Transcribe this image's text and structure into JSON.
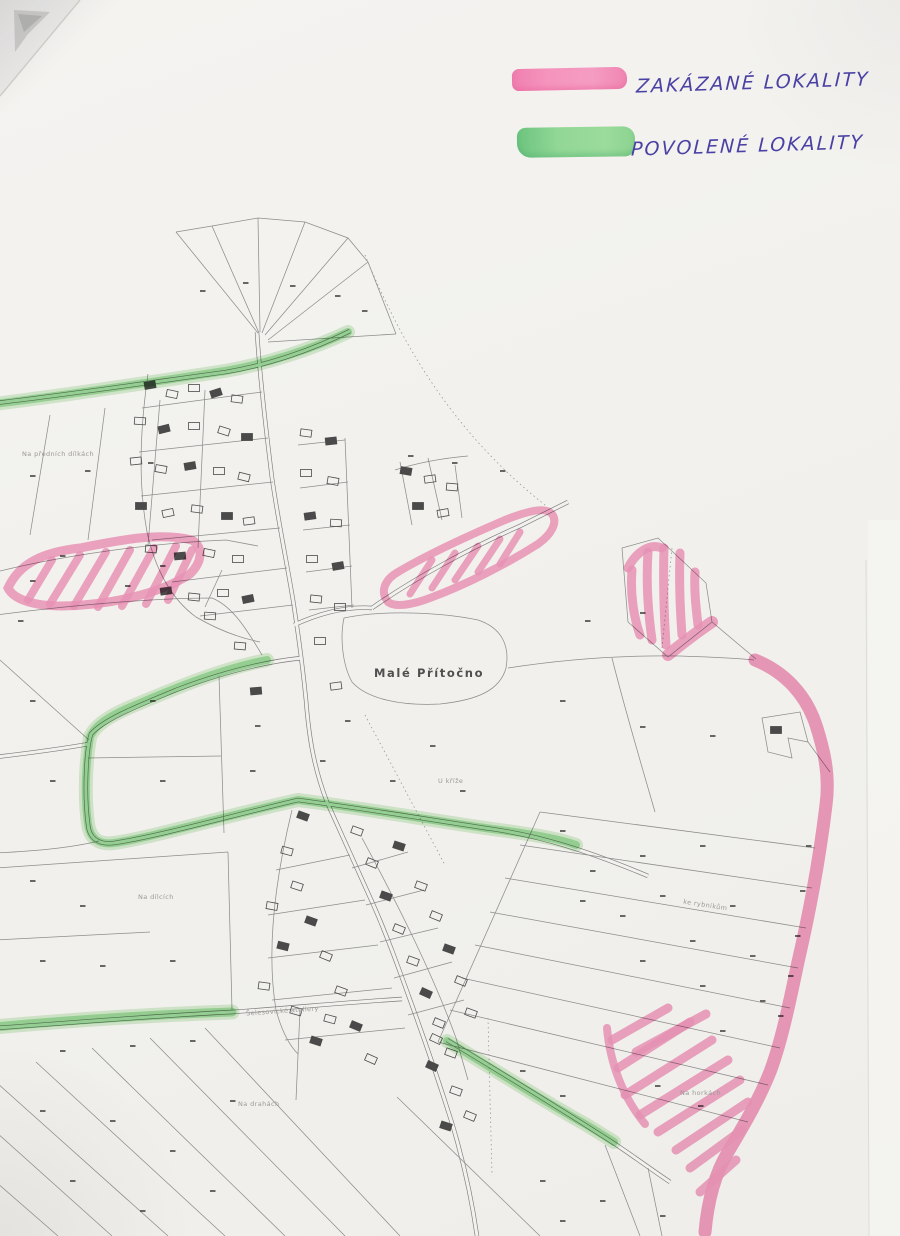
{
  "legend": {
    "items": [
      {
        "label": "ZAKÁZANÉ LOKALITY",
        "color": "#f493bb"
      },
      {
        "label": "POVOLENÉ LOKALITY",
        "color": "#8fd692"
      }
    ],
    "ink_color": "#4a41a4"
  },
  "map": {
    "village_label": "Malé Přítočno",
    "field_labels": [
      {
        "text": "Na předních dílkách"
      },
      {
        "text": "U kříže"
      },
      {
        "text": "Na dílcích"
      },
      {
        "text": "ke rybníkům"
      },
      {
        "text": "Šelesovické ateliery"
      },
      {
        "text": "Na drahách"
      },
      {
        "text": "Na horkách"
      }
    ]
  },
  "colors": {
    "paper": "#f2f1ee",
    "map_line": "#8d8d8d",
    "pink_highlighter": "#f493bb",
    "green_highlighter": "#8fd692",
    "ink": "#4a41a4"
  }
}
